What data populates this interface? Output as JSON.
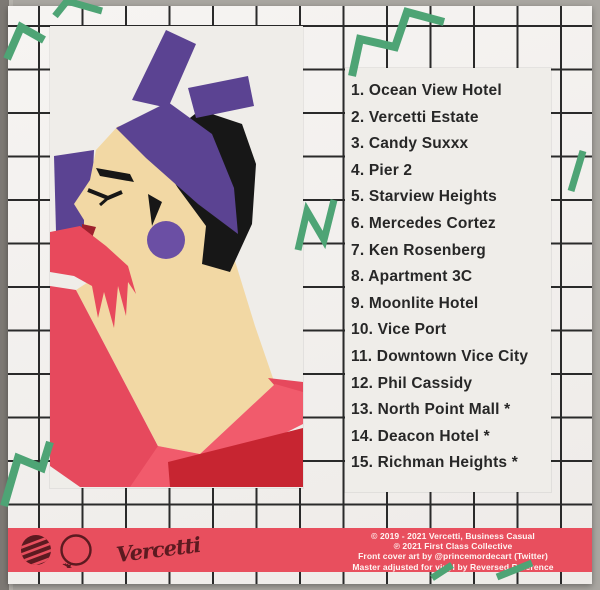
{
  "palette": {
    "surface_gray": "#a9a6a1",
    "cover_white": "#f3f1ee",
    "grid_line": "#2a2a2a",
    "panel_white": "#efede9",
    "accent_green": "#4ea475",
    "banner_red": "#e84f5e",
    "logo_maroon": "#5c1a20",
    "text_black": "#272727",
    "credits_text": "#fff5f3",
    "purple": "#5b4392",
    "skin": "#f2d8a4",
    "glove_red": "#e8495c",
    "dress_red": "#e6495d",
    "dress_dark_red": "#c72531",
    "dress_bright": "#f15b6c",
    "hair_black": "#171717",
    "lips_red": "#9e202c"
  },
  "tracklist": {
    "items": [
      {
        "n": "1.",
        "title": "Ocean View Hotel"
      },
      {
        "n": "2.",
        "title": "Vercetti Estate"
      },
      {
        "n": "3.",
        "title": "Candy Suxxx"
      },
      {
        "n": "4.",
        "title": "Pier 2"
      },
      {
        "n": "5.",
        "title": "Starview Heights"
      },
      {
        "n": "6.",
        "title": "Mercedes Cortez"
      },
      {
        "n": "7.",
        "title": "Ken Rosenberg"
      },
      {
        "n": "8.",
        "title": "Apartment 3C"
      },
      {
        "n": "9.",
        "title": "Moonlite Hotel"
      },
      {
        "n": "10.",
        "title": "Vice Port"
      },
      {
        "n": "11.",
        "title": "Downtown Vice City"
      },
      {
        "n": "12.",
        "title": "Phil Cassidy"
      },
      {
        "n": "13.",
        "title": "North Point Mall *"
      },
      {
        "n": "14.",
        "title": "Deacon Hotel *"
      },
      {
        "n": "15.",
        "title": "Richman Heights *"
      }
    ]
  },
  "banner": {
    "signature": "Vercetti",
    "airplane_glyph": "✈",
    "credits": [
      "© 2019 - 2021 Vercetti, Business Casual",
      "℗ 2021 First Class Collective",
      "Front cover art by @princemordecart (Twitter)",
      "Master adjusted for vinyl by Reversed Reference"
    ]
  }
}
